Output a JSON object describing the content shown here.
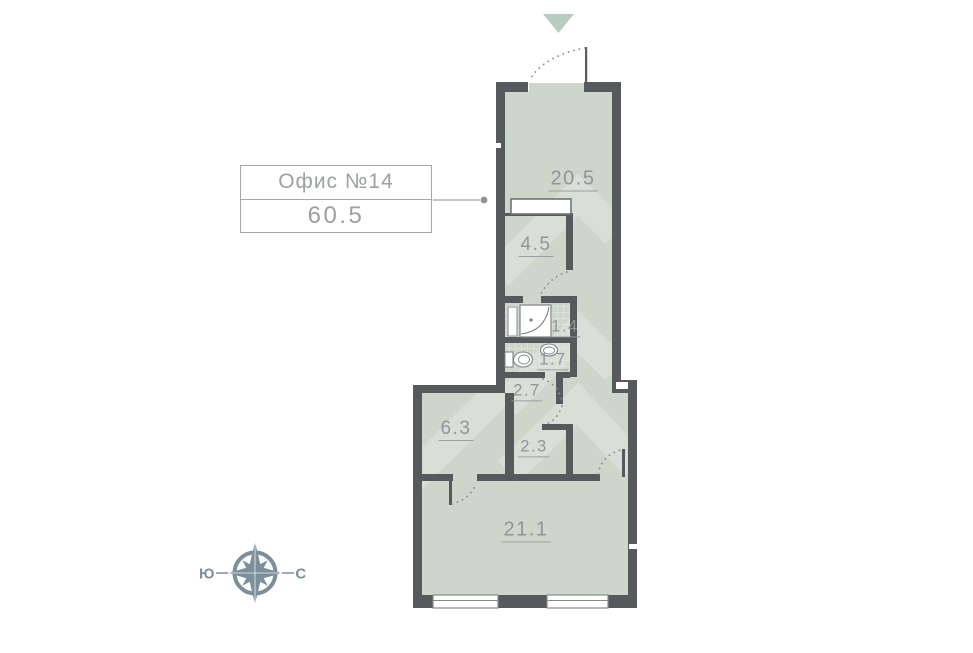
{
  "info_box": {
    "title": "Офис №14",
    "area": "60.5"
  },
  "rooms": [
    {
      "name": "room-20-5",
      "area": "20.5"
    },
    {
      "name": "room-4-5",
      "area": "4.5"
    },
    {
      "name": "room-1-4",
      "area": "1.4"
    },
    {
      "name": "room-1-7",
      "area": "1.7"
    },
    {
      "name": "room-2-7",
      "area": "2.7"
    },
    {
      "name": "room-6-3",
      "area": "6.3"
    },
    {
      "name": "room-2-3",
      "area": "2.3"
    },
    {
      "name": "room-21-1",
      "area": "21.1"
    }
  ],
  "compass": {
    "south": "Ю",
    "north": "С"
  },
  "colors": {
    "wall": "#565a5c",
    "floor": "#ccd6cb",
    "entrance_triangle": "#b8ccc0",
    "compass": "#7d8f9a",
    "label_text": "#8e979a",
    "box_border": "#a3a8ab"
  }
}
